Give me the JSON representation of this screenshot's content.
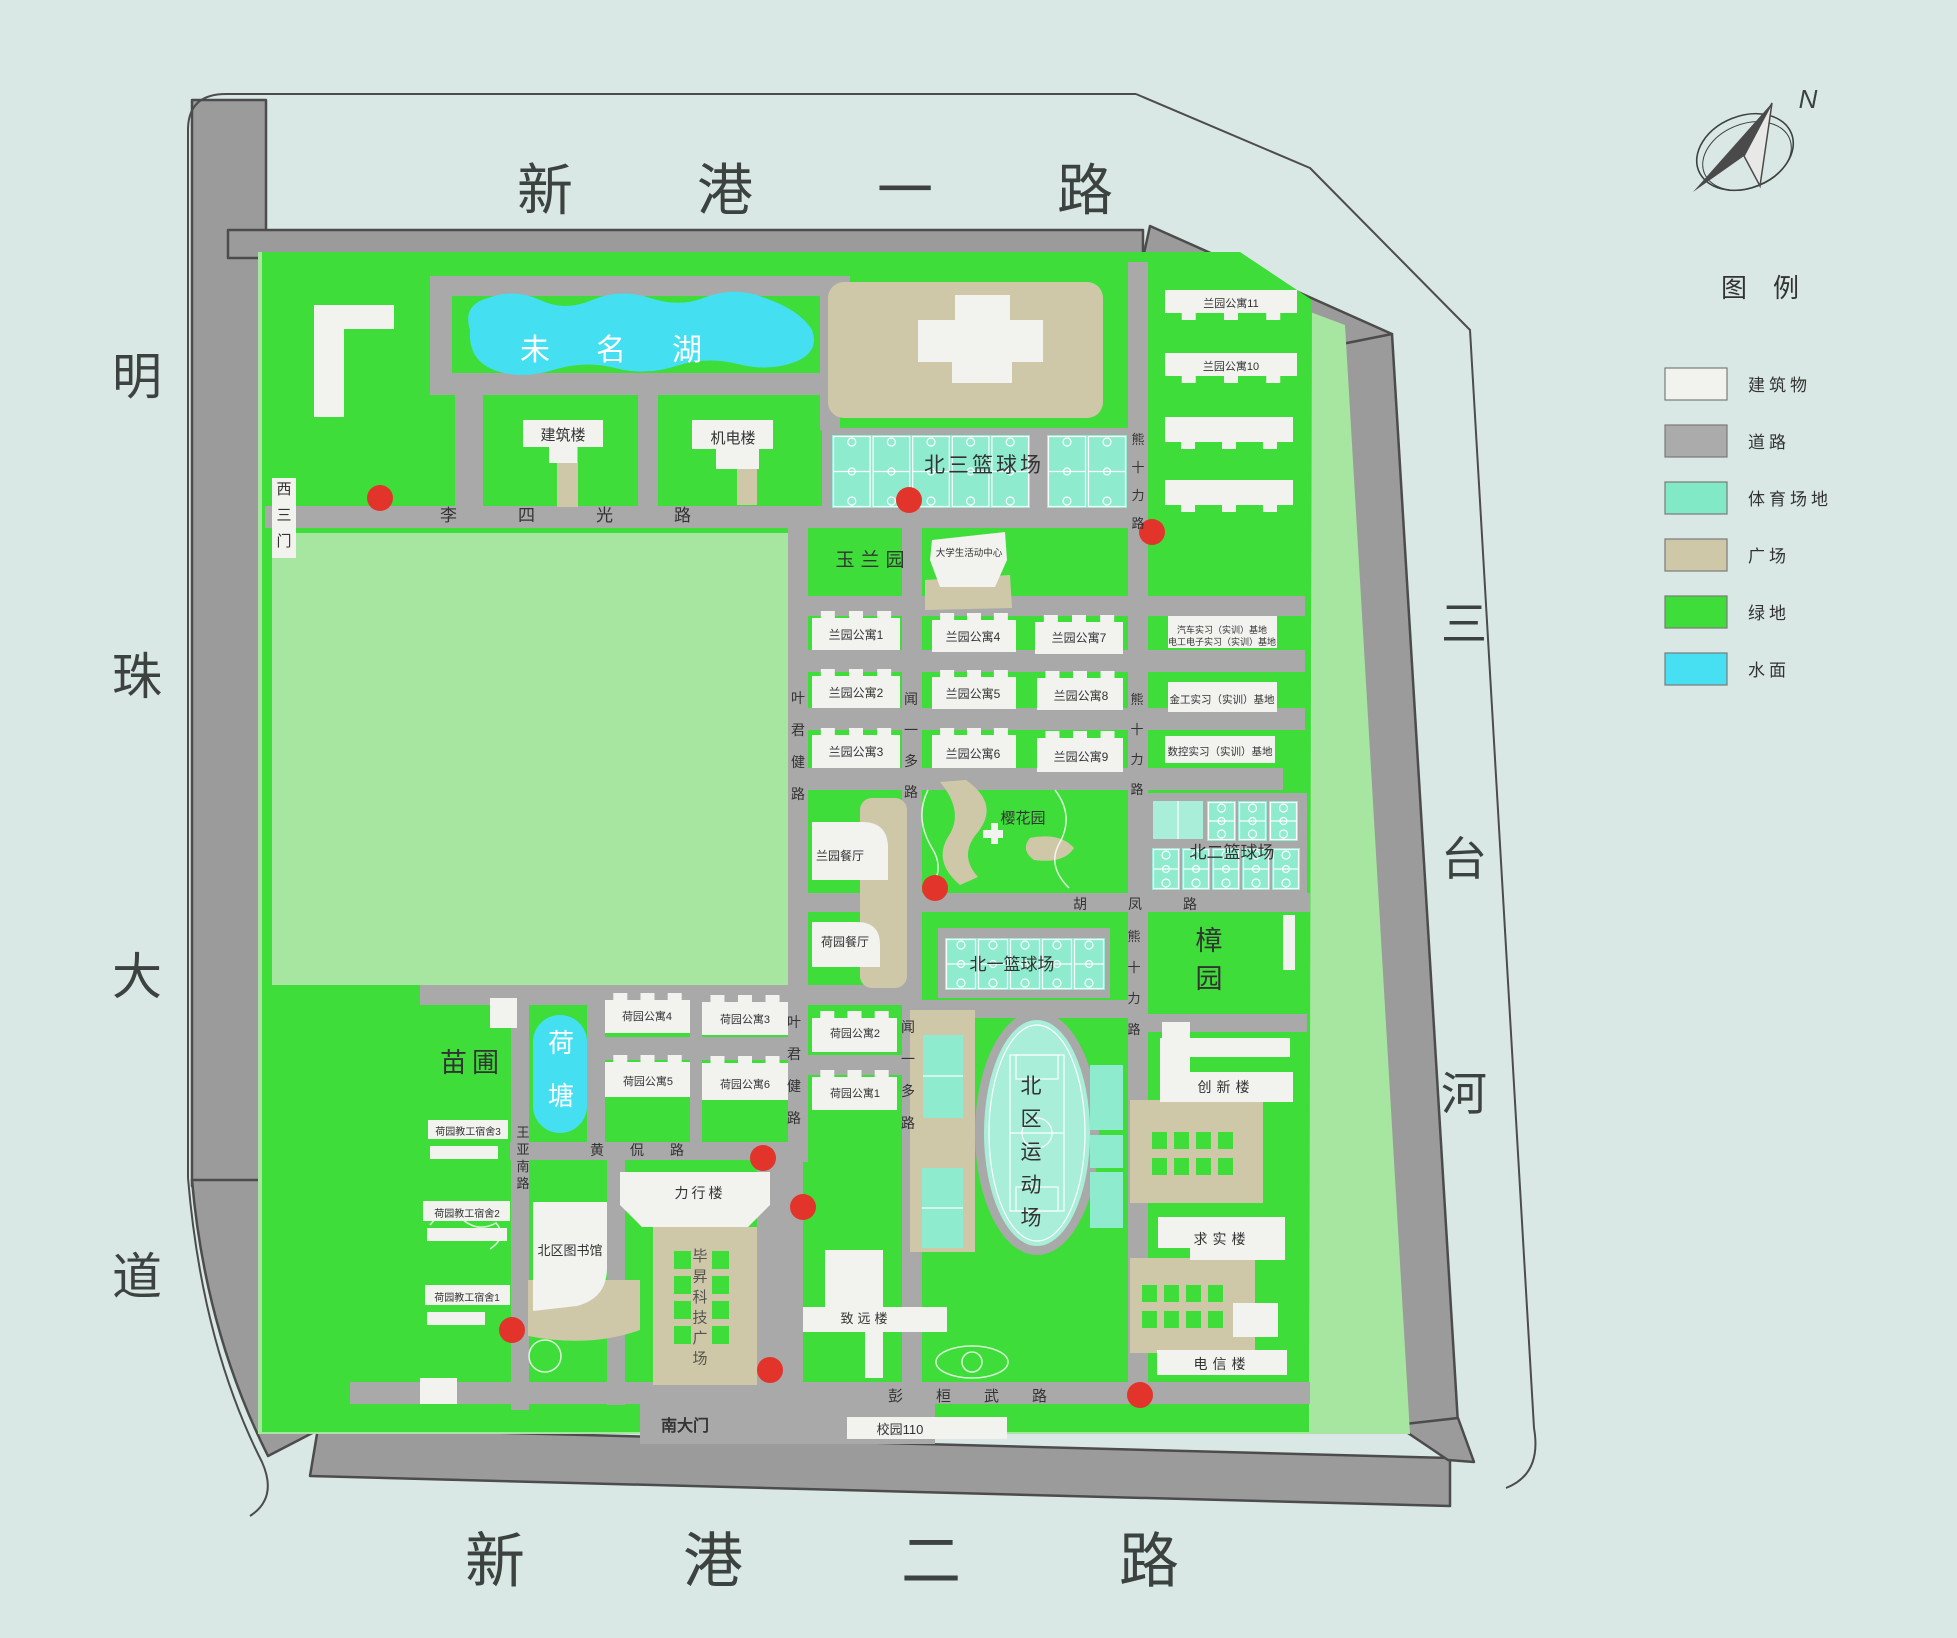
{
  "palette": {
    "bg": "#dae8e5",
    "green": "#3edd3a",
    "pale": "#a7e6a1",
    "water": "#45dff2",
    "mint": "#8febce",
    "mintLight": "#a9eed9",
    "tan": "#cfc8a8",
    "building": "#f2f2ef",
    "road": "#a9a9a9",
    "shoulder": "#9b9b9b",
    "edge": "#4c4c4c",
    "red": "#e2342b",
    "ink": "#333333",
    "frame": "#3c423f"
  },
  "legend": {
    "title": "图例",
    "items": [
      {
        "label": "建筑物",
        "color": "#f2f2ef"
      },
      {
        "label": "道路",
        "color": "#ababab"
      },
      {
        "label": "体育场地",
        "color": "#82e9c6"
      },
      {
        "label": "广场",
        "color": "#cfc8a8"
      },
      {
        "label": "绿地",
        "color": "#3edd3a"
      },
      {
        "label": "水面",
        "color": "#47dff2"
      }
    ]
  },
  "compass": {
    "label": "N"
  },
  "emergency_dots": [
    [
      380,
      498
    ],
    [
      909,
      500
    ],
    [
      1152,
      532
    ],
    [
      935,
      888
    ],
    [
      763,
      1158
    ],
    [
      803,
      1207
    ],
    [
      512,
      1330
    ],
    [
      770,
      1370
    ],
    [
      1140,
      1395
    ]
  ],
  "map": {
    "labels": [
      {
        "id": "road-xingang1",
        "t": "新港一路",
        "x": 517,
        "y": 210,
        "fs": 56,
        "ls": 124,
        "anchor": "start",
        "fill": "#3c423f"
      },
      {
        "id": "road-xingang2",
        "t": "新港二路",
        "x": 465,
        "y": 1582,
        "fs": 60,
        "ls": 158,
        "anchor": "start",
        "fill": "#3c423f"
      },
      {
        "id": "road-mingzhu",
        "t": "明珠大道",
        "x": 137,
        "y": 394,
        "fs": 50,
        "vert": 1,
        "gap": 300,
        "fill": "#3c423f"
      },
      {
        "id": "river-santai",
        "t": "三台河",
        "x": 1464,
        "y": 640,
        "fs": 46,
        "vert": 1,
        "gap": 235,
        "fill": "#3c423f"
      },
      {
        "id": "lake-weiming",
        "t": "未名湖",
        "x": 634,
        "y": 360,
        "fs": 30,
        "ls": 46,
        "fill": "#ffffff"
      },
      {
        "id": "bldg-jianzhu",
        "t": "建筑楼",
        "x": 563,
        "y": 440,
        "fs": 15
      },
      {
        "id": "bldg-jidian",
        "t": "机电楼",
        "x": 733,
        "y": 443,
        "fs": 15
      },
      {
        "id": "court-bei3",
        "t": "北三篮球场",
        "x": 984,
        "y": 472,
        "fs": 21,
        "ls": 3
      },
      {
        "id": "apt-lan11",
        "t": "兰园公寓11",
        "x": 1231,
        "y": 307,
        "fs": 11
      },
      {
        "id": "apt-lan10",
        "t": "兰园公寓10",
        "x": 1231,
        "y": 370,
        "fs": 11
      },
      {
        "id": "gate-west3",
        "t": "西三门",
        "x": 284,
        "y": 494,
        "fs": 15,
        "vert": 1,
        "gap": 26
      },
      {
        "id": "road-lisiguang",
        "t": "李四光路",
        "x": 440,
        "y": 521,
        "fs": 17,
        "ls": 61,
        "anchor": "start"
      },
      {
        "id": "park-yulan",
        "t": "玉兰园",
        "x": 873,
        "y": 566,
        "fs": 19,
        "ls": 6
      },
      {
        "id": "bldg-activity",
        "t": "大学生活动中心",
        "x": 969,
        "y": 556,
        "fs": 9.5
      },
      {
        "id": "apt-lan1",
        "t": "兰园公寓1",
        "x": 856,
        "y": 639,
        "fs": 12
      },
      {
        "id": "apt-lan4",
        "t": "兰园公寓4",
        "x": 973,
        "y": 641,
        "fs": 12
      },
      {
        "id": "apt-lan7",
        "t": "兰园公寓7",
        "x": 1079,
        "y": 642,
        "fs": 12
      },
      {
        "id": "apt-lan2",
        "t": "兰园公寓2",
        "x": 856,
        "y": 697,
        "fs": 12
      },
      {
        "id": "apt-lan5",
        "t": "兰园公寓5",
        "x": 973,
        "y": 698,
        "fs": 12
      },
      {
        "id": "apt-lan8",
        "t": "兰园公寓8",
        "x": 1081,
        "y": 700,
        "fs": 12
      },
      {
        "id": "apt-lan3",
        "t": "兰园公寓3",
        "x": 856,
        "y": 756,
        "fs": 12
      },
      {
        "id": "apt-lan6",
        "t": "兰园公寓6",
        "x": 973,
        "y": 758,
        "fs": 12
      },
      {
        "id": "apt-lan9",
        "t": "兰园公寓9",
        "x": 1081,
        "y": 761,
        "fs": 12
      },
      {
        "id": "base-qiche",
        "t": "汽车实习（实训）基地",
        "x": 1222,
        "y": 633,
        "fs": 9
      },
      {
        "id": "base-diangong",
        "t": "电工电子实习（实训）基地",
        "x": 1222,
        "y": 645,
        "fs": 9
      },
      {
        "id": "base-jingong",
        "t": "金工实习（实训）基地",
        "x": 1222,
        "y": 703,
        "fs": 10.5
      },
      {
        "id": "base-shukong",
        "t": "数控实习（实训）基地",
        "x": 1220,
        "y": 755,
        "fs": 10.5
      },
      {
        "id": "road-yejunjian-n",
        "t": "叶君健路",
        "x": 798,
        "y": 703,
        "fs": 14,
        "vert": 1,
        "gap": 32
      },
      {
        "id": "road-wenyiduo-n",
        "t": "闻一多路",
        "x": 911,
        "y": 704,
        "fs": 14,
        "vert": 1,
        "gap": 31
      },
      {
        "id": "road-xiongshili-n",
        "t": "熊十力路",
        "x": 1138,
        "y": 444,
        "fs": 13,
        "vert": 1,
        "gap": 28
      },
      {
        "id": "road-xiongshili-m",
        "t": "熊十力路",
        "x": 1137,
        "y": 704,
        "fs": 13,
        "vert": 1,
        "gap": 30
      },
      {
        "id": "road-xiongshili-s",
        "t": "熊十力路",
        "x": 1134,
        "y": 941,
        "fs": 13,
        "vert": 1,
        "gap": 31
      },
      {
        "id": "rest-lanyuan",
        "t": "兰园餐厅",
        "x": 840,
        "y": 860,
        "fs": 12
      },
      {
        "id": "rest-heyuan",
        "t": "荷园餐厅",
        "x": 845,
        "y": 946,
        "fs": 12
      },
      {
        "id": "park-yinghua",
        "t": "樱花园",
        "x": 1023,
        "y": 823,
        "fs": 15
      },
      {
        "id": "court-bei2",
        "t": "北二篮球场",
        "x": 1232,
        "y": 858,
        "fs": 17
      },
      {
        "id": "road-hufeng",
        "t": "胡凤路",
        "x": 1073,
        "y": 909,
        "fs": 14,
        "ls": 41,
        "anchor": "start"
      },
      {
        "id": "park-zhang",
        "t": "樟园",
        "x": 1209,
        "y": 950,
        "fs": 27,
        "vert": 1,
        "gap": 38
      },
      {
        "id": "court-bei1",
        "t": "北一篮球场",
        "x": 1012,
        "y": 970,
        "fs": 17
      },
      {
        "id": "nursery-miaopu",
        "t": "苗圃",
        "x": 472,
        "y": 1072,
        "fs": 27,
        "ls": 5
      },
      {
        "id": "pond-hetang",
        "t": "荷塘",
        "x": 561,
        "y": 1052,
        "fs": 26,
        "vert": 1,
        "gap": 53,
        "fill": "#ffffff"
      },
      {
        "id": "apt-he4",
        "t": "荷园公寓4",
        "x": 647,
        "y": 1020,
        "fs": 11
      },
      {
        "id": "apt-he3",
        "t": "荷园公寓3",
        "x": 745,
        "y": 1023,
        "fs": 11
      },
      {
        "id": "apt-he5",
        "t": "荷园公寓5",
        "x": 648,
        "y": 1085,
        "fs": 11
      },
      {
        "id": "apt-he6",
        "t": "荷园公寓6",
        "x": 745,
        "y": 1088,
        "fs": 11
      },
      {
        "id": "apt-he2",
        "t": "荷园公寓2",
        "x": 855,
        "y": 1037,
        "fs": 11
      },
      {
        "id": "apt-he1",
        "t": "荷园公寓1",
        "x": 855,
        "y": 1097,
        "fs": 11
      },
      {
        "id": "road-yejunjian-s",
        "t": "叶君健路",
        "x": 794,
        "y": 1027,
        "fs": 14,
        "vert": 1,
        "gap": 32
      },
      {
        "id": "road-wenyiduo-s",
        "t": "闻一多路",
        "x": 908,
        "y": 1032,
        "fs": 14,
        "vert": 1,
        "gap": 32
      },
      {
        "id": "stadium-beiqu",
        "t": "北区运动场",
        "x": 1031,
        "y": 1093,
        "fs": 21,
        "vert": 1,
        "gap": 33
      },
      {
        "id": "dorm-he3",
        "t": "荷园教工宿舍3",
        "x": 468,
        "y": 1135,
        "fs": 10
      },
      {
        "id": "dorm-he2",
        "t": "荷园教工宿舍2",
        "x": 467,
        "y": 1217,
        "fs": 10
      },
      {
        "id": "dorm-he1",
        "t": "荷园教工宿舍1",
        "x": 467,
        "y": 1301,
        "fs": 10
      },
      {
        "id": "road-huangkan",
        "t": "黄侃路",
        "x": 590,
        "y": 1155,
        "fs": 14,
        "ls": 26,
        "anchor": "start"
      },
      {
        "id": "road-wangyanan",
        "t": "王亚南路",
        "x": 523,
        "y": 1137,
        "fs": 13,
        "vert": 1,
        "gap": 17
      },
      {
        "id": "lib-beiqu",
        "t": "北区图书馆",
        "x": 570,
        "y": 1255,
        "fs": 13
      },
      {
        "id": "bldg-lixing",
        "t": "力行楼",
        "x": 700,
        "y": 1198,
        "fs": 14,
        "ls": 3
      },
      {
        "id": "plaza-bisheng",
        "t": "毕昇科技广场",
        "x": 700,
        "y": 1261,
        "fs": 15,
        "vert": 1,
        "gap": 20.5,
        "fill": "#555550"
      },
      {
        "id": "bldg-zhiyuan",
        "t": "致远楼",
        "x": 866,
        "y": 1323,
        "fs": 13,
        "ls": 4
      },
      {
        "id": "bldg-chuangxin",
        "t": "创新楼",
        "x": 1226,
        "y": 1092,
        "fs": 14,
        "ls": 5
      },
      {
        "id": "bldg-qiushi",
        "t": "求实楼",
        "x": 1222,
        "y": 1244,
        "fs": 14,
        "ls": 5
      },
      {
        "id": "bldg-dianxin",
        "t": "电信楼",
        "x": 1222,
        "y": 1369,
        "fs": 14,
        "ls": 5
      },
      {
        "id": "road-penghuanwu",
        "t": "彭桓武路",
        "x": 888,
        "y": 1401,
        "fs": 15,
        "ls": 33,
        "anchor": "start"
      },
      {
        "id": "gate-south",
        "t": "南大门",
        "x": 685,
        "y": 1431,
        "fs": 16,
        "b": 1
      },
      {
        "id": "campus110",
        "t": "校园110",
        "x": 900,
        "y": 1434,
        "fs": 13
      },
      {
        "id": "legend-title",
        "t": "图例",
        "x": 1773,
        "y": 297,
        "fs": 26,
        "ls": 26
      },
      {
        "id": "compass-n",
        "t": "N",
        "x": 1808,
        "y": 108,
        "fs": 26,
        "i": 1,
        "fill": "#3c423f"
      }
    ]
  }
}
